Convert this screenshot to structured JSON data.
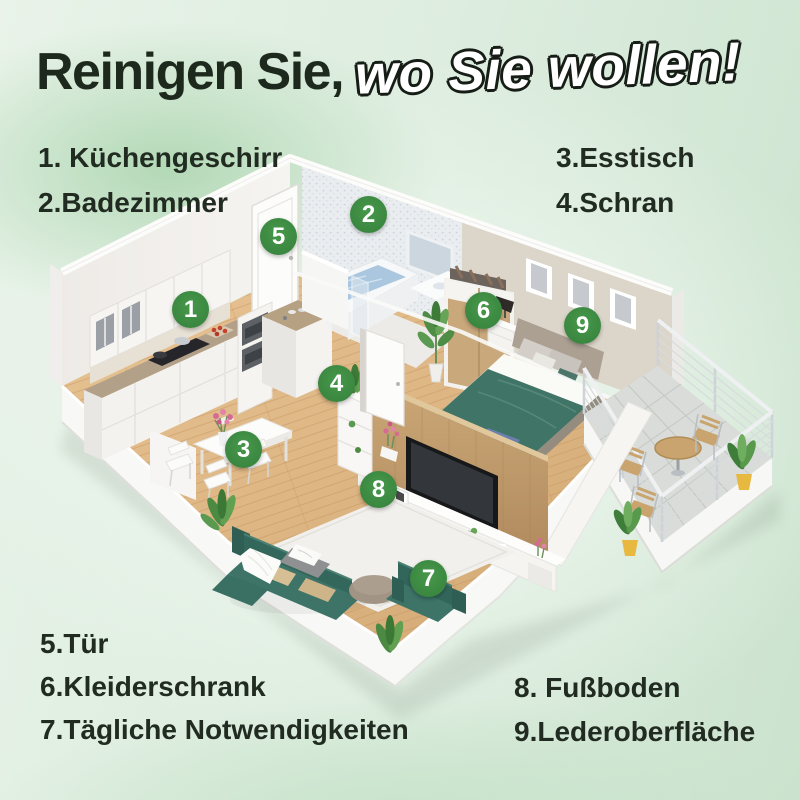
{
  "title": {
    "part1": "Reinigen Sie,",
    "part2": "wo Sie wollen!"
  },
  "legend": {
    "top_left": [
      "1. Küchengeschirr",
      "2.Badezimmer"
    ],
    "top_right": [
      "3.Esstisch",
      "4.Schran"
    ],
    "bottom_left": [
      "5.Tür",
      "6.Kleiderschrank",
      "7.Tägliche Notwendigkeiten"
    ],
    "bottom_right": [
      "8. Fußboden",
      "9.Lederoberfläche"
    ]
  },
  "markers": [
    {
      "number": "1",
      "label": "Küchengeschirr",
      "x": 190,
      "y": 309
    },
    {
      "number": "2",
      "label": "Badezimmer",
      "x": 368,
      "y": 214
    },
    {
      "number": "3",
      "label": "Esstisch",
      "x": 243,
      "y": 449
    },
    {
      "number": "4",
      "label": "Schran",
      "x": 336,
      "y": 383
    },
    {
      "number": "5",
      "label": "Tür",
      "x": 278,
      "y": 236
    },
    {
      "number": "6",
      "label": "Kleiderschrank",
      "x": 483,
      "y": 310
    },
    {
      "number": "7",
      "label": "Tägliche Notwendigkeiten",
      "x": 428,
      "y": 578
    },
    {
      "number": "8",
      "label": "Fußboden",
      "x": 378,
      "y": 489
    },
    {
      "number": "9",
      "label": "Lederoberfläche",
      "x": 582,
      "y": 325
    }
  ],
  "colors": {
    "badge_green": "#3e8e41",
    "title_dark": "#1e291e",
    "outline_fill": "#ffffff",
    "outline_stroke": "#161c16",
    "wood_floor": "#ddb687",
    "teal_furniture": "#3d7467",
    "bedroom_wall": "#dcd5ca"
  }
}
